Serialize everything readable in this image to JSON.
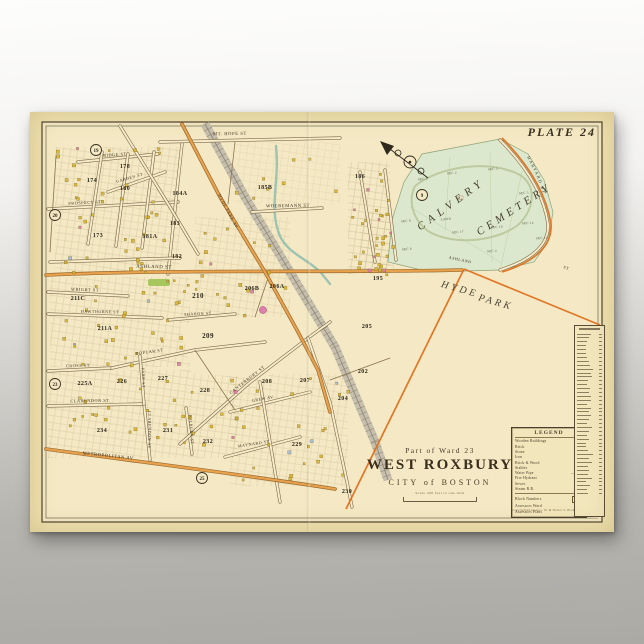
{
  "scene": {
    "bg_top": "#fdfdfc",
    "bg_bottom": "#acaaa5"
  },
  "poster": {
    "plate_label": "PLATE 24",
    "paper": "#efe1ae",
    "map_bg": "#f4e9c4",
    "line": "#3c3322"
  },
  "title_block": {
    "ward_line": "Part of Ward 23",
    "title": "WEST ROXBURY",
    "subtitle": "CITY of BOSTON",
    "scale_note": "Scale 200 feet to one inch"
  },
  "legend": {
    "header": "LEGEND",
    "items": [
      {
        "label": "Wooden Buildings",
        "swatch": "#e8c42f"
      },
      {
        "label": "Brick",
        "swatch": "#e59aac"
      },
      {
        "label": "Stone",
        "swatch": "#a9bdd6"
      },
      {
        "label": "Iron",
        "swatch": "#b3a945"
      },
      {
        "label": "Brick & Wood",
        "swatch": "#dfa04e"
      },
      {
        "label": "Stables",
        "swatch": "#cfc49a"
      },
      {
        "label": "Water Pipe",
        "symbol": "———"
      },
      {
        "label": "Fire Hydrant",
        "symbol": "•"
      },
      {
        "label": "Sewer",
        "symbol": "– – –"
      },
      {
        "label": "Steam R.R.",
        "symbol": "┼┼┼"
      }
    ],
    "footer_items": [
      {
        "label": "Block Numbers",
        "value": "612",
        "big": false
      },
      {
        "label": "Assessors Ward",
        "value": "—",
        "big": false
      },
      {
        "label": "Assessors Plans",
        "value": "3",
        "big": true
      }
    ],
    "copyright": "Copyrighted by Geo. W. & Walter S. Bromley"
  },
  "index_column": {
    "rows": 42
  },
  "map": {
    "colors": {
      "road_tan_casing": "#7d6a49",
      "road_tan_fill": "#f6ecca",
      "road_orange_casing": "#9a6a2e",
      "road_orange_fill": "#e8a24e",
      "boundary": "#e0701d",
      "cemetery_fill": "#dce8cd",
      "cemetery_edge": "#8fa27a",
      "cemetery_inner": "#b9c79b",
      "rr_band": "#c6bfae",
      "rr_line": "#8d8370",
      "stream": "#8fbcae",
      "building_yellow": "#dcb72e",
      "building_pink": "#df7fae",
      "building_blue": "#a9bdd6",
      "park_green": "#9ec353",
      "text": "#3a3020",
      "section_text": "#4a4a38"
    },
    "texture_rects": [
      [
        25,
        35,
        125,
        125,
        0.5
      ],
      [
        20,
        165,
        140,
        90,
        0.5
      ],
      [
        18,
        258,
        190,
        88,
        0.5
      ],
      [
        165,
        105,
        95,
        100,
        0.42
      ],
      [
        200,
        262,
        118,
        112,
        0.45
      ],
      [
        318,
        50,
        42,
        112,
        0.6
      ],
      [
        205,
        30,
        105,
        62,
        0.28
      ],
      [
        330,
        100,
        34,
        58,
        0.45
      ]
    ],
    "blank_polys": [
      "150,212 240,208 258,248 236,266 162,262",
      "434,158 570,213 570,406 318,398"
    ],
    "cemetery": {
      "outline": "358,150 362,108 374,70 392,42 470,27 498,42 514,68 523,100 518,130 504,150 470,158 400,160",
      "inner_road": "M385,74 C410,54 460,47 490,63 C506,73 506,96 488,113 C464,131 420,133 398,119 C382,107 378,88 385,74",
      "names": [
        {
          "t": "CALVERY",
          "x": 423,
          "y": 95,
          "rot": -36,
          "size": 11,
          "ls": 5
        },
        {
          "t": "CEMETERY",
          "x": 486,
          "y": 100,
          "rot": -33,
          "size": 11,
          "ls": 4
        }
      ],
      "sections": [
        {
          "t": "SEC 1",
          "x": 393,
          "y": 68
        },
        {
          "t": "SEC 2",
          "x": 422,
          "y": 62
        },
        {
          "t": "SEC 3",
          "x": 463,
          "y": 58
        },
        {
          "t": "SEC 5",
          "x": 494,
          "y": 82
        },
        {
          "t": "LAWN",
          "x": 416,
          "y": 108
        },
        {
          "t": "SEC 17",
          "x": 428,
          "y": 121
        },
        {
          "t": "SEC 10",
          "x": 467,
          "y": 116
        },
        {
          "t": "SEC 14",
          "x": 498,
          "y": 112
        },
        {
          "t": "SEC 12",
          "x": 512,
          "y": 127
        },
        {
          "t": "SEC 8",
          "x": 376,
          "y": 110
        },
        {
          "t": "SEC 6",
          "x": 377,
          "y": 138
        },
        {
          "t": "SEC 4",
          "x": 462,
          "y": 140
        }
      ],
      "curve_street": {
        "t": "HARVARD ST",
        "path": "M 494,40 Q 515,75 518,108"
      }
    },
    "railroad": {
      "pts": [
        [
          175,
          12
        ],
        [
          215,
          85
        ],
        [
          260,
          160
        ],
        [
          305,
          235
        ],
        [
          345,
          330
        ],
        [
          358,
          368
        ]
      ]
    },
    "stream": {
      "d": "M246,34 C250,70 238,96 250,124 C258,142 280,148 292,162 L300,172"
    },
    "roads": [
      {
        "d": "M130,30 L310,26",
        "k": "tan"
      },
      {
        "d": "M18,97 L148,90",
        "k": "tan"
      },
      {
        "d": "M48,50 L128,42",
        "k": "tan"
      },
      {
        "d": "M18,180 L98,184",
        "k": "tan"
      },
      {
        "d": "M18,202 L132,206",
        "k": "tan"
      },
      {
        "d": "M138,208 L205,202",
        "k": "tan"
      },
      {
        "d": "M18,259 L82,256",
        "k": "tan"
      },
      {
        "d": "M82,256 L165,238 L235,230",
        "k": "tan"
      },
      {
        "d": "M18,294 L112,292",
        "k": "tan"
      },
      {
        "d": "M114,292 L120,348",
        "k": "tan"
      },
      {
        "d": "M110,244 L114,292",
        "k": "tan"
      },
      {
        "d": "M156,296 L162,342",
        "k": "tan"
      },
      {
        "d": "M222,100 L292,96",
        "k": "tan"
      },
      {
        "d": "M72,40 L58,132",
        "k": "tan"
      },
      {
        "d": "M98,42 L86,134",
        "k": "tan"
      },
      {
        "d": "M124,40 L112,136",
        "k": "tan"
      },
      {
        "d": "M152,32 L138,162",
        "k": "tan"
      },
      {
        "d": "M78,80 L135,60",
        "k": "tan"
      },
      {
        "d": "M20,150 L150,146",
        "k": "tan"
      },
      {
        "d": "M90,14 L140,95 L168,142",
        "k": "tan"
      },
      {
        "d": "M150,332 L218,272 L278,226 L300,210",
        "k": "tan"
      },
      {
        "d": "M278,226 L300,290 L317,370 L322,395",
        "k": "tan"
      },
      {
        "d": "M195,345 L270,325",
        "k": "tan"
      },
      {
        "d": "M200,300 L280,280",
        "k": "tan"
      },
      {
        "d": "M230,270 L250,390",
        "k": "tan"
      },
      {
        "d": "M330,60 L345,150",
        "k": "tan"
      },
      {
        "d": "M355,58 L366,148",
        "k": "tan"
      },
      {
        "d": "M470,28 Q512,70 518,112 Q520,142 470,158",
        "k": "tan"
      },
      {
        "d": "M205,30 L198,92",
        "k": "thin"
      },
      {
        "d": "M240,160 L225,205",
        "k": "thin"
      },
      {
        "d": "M165,238 L205,298",
        "k": "thin"
      },
      {
        "d": "M300,268 L360,246",
        "k": "thin"
      },
      {
        "d": "M26,44 L20,140",
        "k": "thin"
      },
      {
        "d": "M16,163 C150,157 300,161 432,158",
        "k": "orange"
      },
      {
        "d": "M152,12 L190,85 L235,160 L268,220 L288,258 L300,300",
        "k": "orange"
      },
      {
        "d": "M16,337 C110,350 210,362 305,377",
        "k": "orange"
      }
    ],
    "boundary_lines": [
      "M434,157 L316,397",
      "M434,157 L570,213",
      "M472,26 Q514,68 521,112 Q523,144 472,160"
    ],
    "labels": [
      {
        "t": "MT. HOPE ST",
        "x": 200,
        "y": 23,
        "rot": -1,
        "size": 4.6,
        "style": "street"
      },
      {
        "t": "RIDGE ST",
        "x": 85,
        "y": 44,
        "rot": -4,
        "size": 4.2,
        "style": "street"
      },
      {
        "t": "PROSPECT ST",
        "x": 55,
        "y": 92,
        "rot": -3,
        "size": 4.2,
        "style": "street"
      },
      {
        "t": "GARDEN ST",
        "x": 100,
        "y": 67,
        "rot": -16,
        "size": 4,
        "style": "street"
      },
      {
        "t": "WRIGHT ST",
        "x": 55,
        "y": 179,
        "rot": 2,
        "size": 4.2,
        "style": "street"
      },
      {
        "t": "HAWTHORNE ST",
        "x": 70,
        "y": 201,
        "rot": 1,
        "size": 4,
        "style": "street"
      },
      {
        "t": "SHARON ST",
        "x": 168,
        "y": 203,
        "rot": -3,
        "size": 4,
        "style": "street"
      },
      {
        "t": "CROSS ST",
        "x": 48,
        "y": 255,
        "rot": -2,
        "size": 4.2,
        "style": "street"
      },
      {
        "t": "POPLAR ST",
        "x": 120,
        "y": 241,
        "rot": -8,
        "size": 4.2,
        "style": "street"
      },
      {
        "t": "CLARENDON ST",
        "x": 60,
        "y": 290,
        "rot": -1,
        "size": 4.2,
        "style": "street"
      },
      {
        "t": "CLARENDON AV",
        "x": 118,
        "y": 318,
        "rot": 90,
        "size": 4,
        "style": "street"
      },
      {
        "t": "PARK ST",
        "x": 112,
        "y": 266,
        "rot": 88,
        "size": 4,
        "style": "street"
      },
      {
        "t": "KILBURN ST",
        "x": 160,
        "y": 318,
        "rot": 86,
        "size": 4,
        "style": "street"
      },
      {
        "t": "METROPOLITAN AV",
        "x": 78,
        "y": 345,
        "rot": 6,
        "size": 4.6,
        "style": "street"
      },
      {
        "t": "CANTERBURY ST",
        "x": 218,
        "y": 269,
        "rot": -38,
        "size": 4.4,
        "style": "street"
      },
      {
        "t": "GREW AV",
        "x": 233,
        "y": 288,
        "rot": -10,
        "size": 4,
        "style": "street"
      },
      {
        "t": "MAYNARD ST",
        "x": 224,
        "y": 333,
        "rot": -9,
        "size": 4,
        "style": "street"
      },
      {
        "t": "WOEREMANN ST",
        "x": 258,
        "y": 95,
        "rot": -1,
        "size": 4.6,
        "style": "street"
      },
      {
        "t": "HYDE PARK AV",
        "x": 197,
        "y": 100,
        "rot": 62,
        "size": 4.4,
        "style": "street"
      },
      {
        "t": "ASHLAND ST",
        "x": 124,
        "y": 156,
        "rot": 1,
        "size": 4.8,
        "style": "street"
      },
      {
        "t": "ASHLAND",
        "x": 430,
        "y": 149,
        "rot": 12,
        "size": 4,
        "style": "street"
      },
      {
        "t": "ST",
        "x": 536,
        "y": 157,
        "rot": 18,
        "size": 4,
        "style": "street"
      },
      {
        "t": "HYDE",
        "x": 429,
        "y": 180,
        "rot": 16,
        "size": 10,
        "style": "place"
      },
      {
        "t": "PARK",
        "x": 465,
        "y": 193,
        "rot": 16,
        "size": 10,
        "style": "place"
      }
    ],
    "block_numbers": [
      {
        "n": "178",
        "x": 95,
        "y": 56
      },
      {
        "n": "174",
        "x": 62,
        "y": 70
      },
      {
        "n": "180",
        "x": 95,
        "y": 78
      },
      {
        "n": "184A",
        "x": 150,
        "y": 83
      },
      {
        "n": "183",
        "x": 145,
        "y": 113
      },
      {
        "n": "173",
        "x": 68,
        "y": 125
      },
      {
        "n": "181A",
        "x": 120,
        "y": 126
      },
      {
        "n": "182",
        "x": 147,
        "y": 146
      },
      {
        "n": "185B",
        "x": 235,
        "y": 77
      },
      {
        "n": "186",
        "x": 330,
        "y": 66
      },
      {
        "n": "195",
        "x": 348,
        "y": 168
      },
      {
        "n": "205",
        "x": 337,
        "y": 216
      },
      {
        "n": "210",
        "x": 168,
        "y": 186
      },
      {
        "n": "211A",
        "x": 75,
        "y": 218
      },
      {
        "n": "211C",
        "x": 48,
        "y": 188
      },
      {
        "n": "206B",
        "x": 222,
        "y": 178
      },
      {
        "n": "206A",
        "x": 247,
        "y": 176
      },
      {
        "n": "209",
        "x": 178,
        "y": 226
      },
      {
        "n": "208",
        "x": 237,
        "y": 271
      },
      {
        "n": "207",
        "x": 275,
        "y": 270
      },
      {
        "n": "202",
        "x": 333,
        "y": 261
      },
      {
        "n": "204",
        "x": 313,
        "y": 288
      },
      {
        "n": "229",
        "x": 267,
        "y": 334
      },
      {
        "n": "231",
        "x": 138,
        "y": 320
      },
      {
        "n": "230",
        "x": 317,
        "y": 381
      },
      {
        "n": "225A",
        "x": 55,
        "y": 273
      },
      {
        "n": "226",
        "x": 92,
        "y": 271
      },
      {
        "n": "227",
        "x": 133,
        "y": 268
      },
      {
        "n": "228",
        "x": 175,
        "y": 280
      },
      {
        "n": "234",
        "x": 72,
        "y": 320
      },
      {
        "n": "232",
        "x": 178,
        "y": 331
      }
    ],
    "circled_refs": [
      {
        "n": "19",
        "x": 66,
        "y": 38
      },
      {
        "n": "20",
        "x": 25,
        "y": 103
      },
      {
        "n": "23",
        "x": 25,
        "y": 272
      },
      {
        "n": "25",
        "x": 172,
        "y": 366
      },
      {
        "n": "9",
        "x": 392,
        "y": 83
      }
    ],
    "building_regions": [
      {
        "x": 25,
        "y": 35,
        "w": 125,
        "h": 125,
        "count": 42
      },
      {
        "x": 20,
        "y": 165,
        "w": 140,
        "h": 88,
        "count": 34
      },
      {
        "x": 20,
        "y": 262,
        "w": 185,
        "h": 80,
        "count": 30
      },
      {
        "x": 165,
        "y": 105,
        "w": 95,
        "h": 100,
        "count": 20
      },
      {
        "x": 200,
        "y": 262,
        "w": 118,
        "h": 108,
        "count": 26
      },
      {
        "x": 318,
        "y": 52,
        "w": 40,
        "h": 110,
        "count": 22
      },
      {
        "x": 330,
        "y": 100,
        "w": 32,
        "h": 58,
        "count": 12
      },
      {
        "x": 205,
        "y": 30,
        "w": 100,
        "h": 60,
        "count": 8
      }
    ],
    "special_features": {
      "park_rect": {
        "x": 118,
        "y": 167,
        "w": 22,
        "h": 7
      },
      "pink_circle": {
        "x": 233,
        "y": 198,
        "r": 3.5
      }
    }
  }
}
